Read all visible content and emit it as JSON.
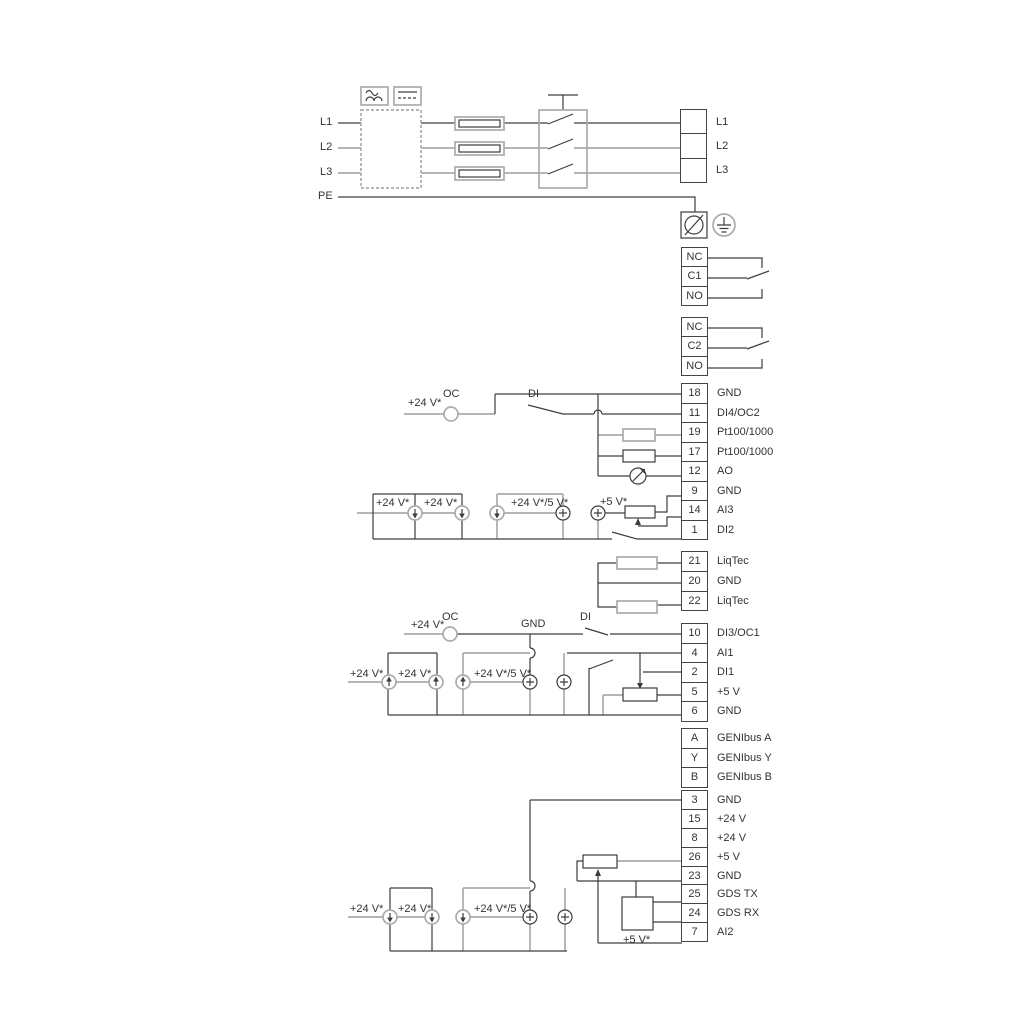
{
  "annotations": {
    "v24": "+24 V*",
    "v24_5": "+24 V*/5 V*",
    "v5": "+5 V*",
    "oc": "OC",
    "di": "DI",
    "gnd": "GND"
  },
  "power": {
    "inputs": [
      "L1",
      "L2",
      "L3",
      "PE"
    ],
    "outputs": [
      {
        "pin": "",
        "label": "L1"
      },
      {
        "pin": "",
        "label": "L2"
      },
      {
        "pin": "",
        "label": "L3"
      }
    ]
  },
  "relay1": [
    {
      "pin": "NC",
      "label": ""
    },
    {
      "pin": "C1",
      "label": ""
    },
    {
      "pin": "NO",
      "label": ""
    }
  ],
  "relay2": [
    {
      "pin": "NC",
      "label": ""
    },
    {
      "pin": "C2",
      "label": ""
    },
    {
      "pin": "NO",
      "label": ""
    }
  ],
  "io1": [
    {
      "pin": "18",
      "label": "GND"
    },
    {
      "pin": "11",
      "label": "DI4/OC2"
    },
    {
      "pin": "19",
      "label": "Pt100/1000"
    },
    {
      "pin": "17",
      "label": "Pt100/1000"
    },
    {
      "pin": "12",
      "label": "AO"
    },
    {
      "pin": "9",
      "label": "GND"
    },
    {
      "pin": "14",
      "label": "AI3"
    },
    {
      "pin": "1",
      "label": "DI2"
    }
  ],
  "liqtec": [
    {
      "pin": "21",
      "label": "LiqTec"
    },
    {
      "pin": "20",
      "label": "GND"
    },
    {
      "pin": "22",
      "label": "LiqTec"
    }
  ],
  "io2": [
    {
      "pin": "10",
      "label": "DI3/OC1"
    },
    {
      "pin": "4",
      "label": "AI1"
    },
    {
      "pin": "2",
      "label": "DI1"
    },
    {
      "pin": "5",
      "label": "+5 V"
    },
    {
      "pin": "6",
      "label": "GND"
    }
  ],
  "genibus": [
    {
      "pin": "A",
      "label": "GENIbus A"
    },
    {
      "pin": "Y",
      "label": "GENIbus Y"
    },
    {
      "pin": "B",
      "label": "GENIbus B"
    }
  ],
  "io3": [
    {
      "pin": "3",
      "label": "GND"
    },
    {
      "pin": "15",
      "label": "+24 V"
    },
    {
      "pin": "8",
      "label": "+24 V"
    },
    {
      "pin": "26",
      "label": "+5 V"
    },
    {
      "pin": "23",
      "label": "GND"
    },
    {
      "pin": "25",
      "label": "GDS TX"
    },
    {
      "pin": "24",
      "label": "GDS RX"
    },
    {
      "pin": "7",
      "label": "AI2"
    }
  ]
}
